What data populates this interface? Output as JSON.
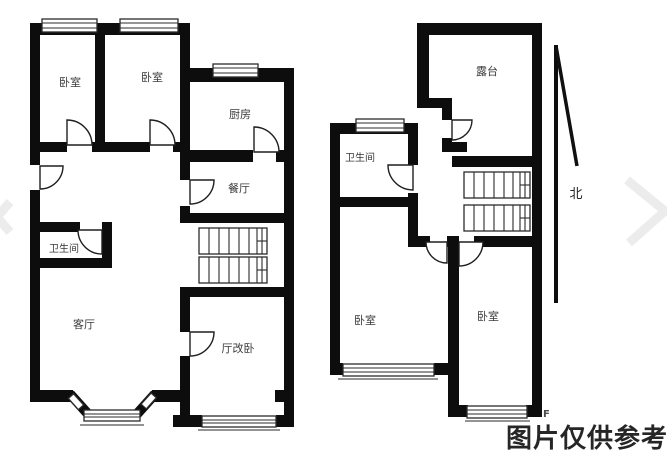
{
  "floor_plan_left": {
    "rooms": [
      {
        "id": "bedroom-1",
        "label": "卧室"
      },
      {
        "id": "bedroom-2",
        "label": "卧室"
      },
      {
        "id": "kitchen",
        "label": "厨房"
      },
      {
        "id": "dining-room",
        "label": "餐厅"
      },
      {
        "id": "bathroom",
        "label": "卫生间"
      },
      {
        "id": "living-room",
        "label": "客厅"
      },
      {
        "id": "hall-bedroom",
        "label": "厅改卧"
      }
    ]
  },
  "floor_plan_right": {
    "rooms": [
      {
        "id": "terrace",
        "label": "露台"
      },
      {
        "id": "bathroom",
        "label": "卫生间"
      },
      {
        "id": "bedroom-left",
        "label": "卧室"
      },
      {
        "id": "bedroom-right",
        "label": "卧室"
      }
    ]
  },
  "compass": {
    "label": "北"
  },
  "watermark": {
    "text": "图片仅供参考",
    "corner_mark": "F"
  },
  "colors": {
    "wall": "#0d0d0d",
    "line": "#2b2b2b",
    "room_label": "#3a3a3a",
    "watermark": "#262626",
    "chevron": "#ececec"
  }
}
